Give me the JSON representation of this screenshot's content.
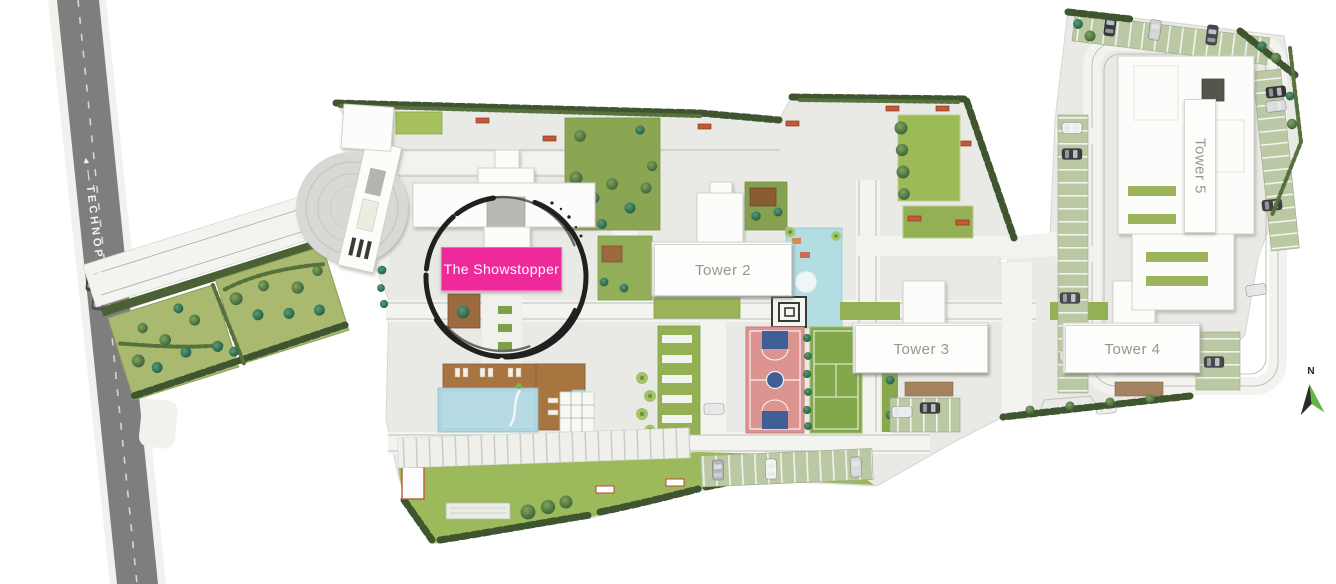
{
  "page": {
    "type": "residential-site-plan"
  },
  "road": {
    "label": "TECHNOPOLIS",
    "arrow": "◄",
    "dots": "┄┄"
  },
  "towers": [
    {
      "id": "showstopper",
      "label": "The Showstopper",
      "highlighted": true
    },
    {
      "id": "tower-2",
      "label": "Tower 2"
    },
    {
      "id": "tower-3",
      "label": "Tower 3"
    },
    {
      "id": "tower-4",
      "label": "Tower 4"
    },
    {
      "id": "tower-5",
      "label": "Tower 5"
    }
  ],
  "compass": {
    "north_label": "N"
  },
  "annotation": {
    "shape": "hand-drawn-circle",
    "around": "The Showstopper"
  },
  "colors": {
    "highlight_pink": "#ee2a9b",
    "land_gray": "#e9e9e6",
    "road_gray": "#7e7e7e",
    "lawn_green": "#9cba5c",
    "hedge_green": "#3f5530",
    "pool_blue": "#aed6e0",
    "court_salmon": "#db9490",
    "court_key_blue": "#3f5f96",
    "court_green": "#83a74b",
    "compass_green": "#66b544",
    "annotation_black": "#161616"
  }
}
